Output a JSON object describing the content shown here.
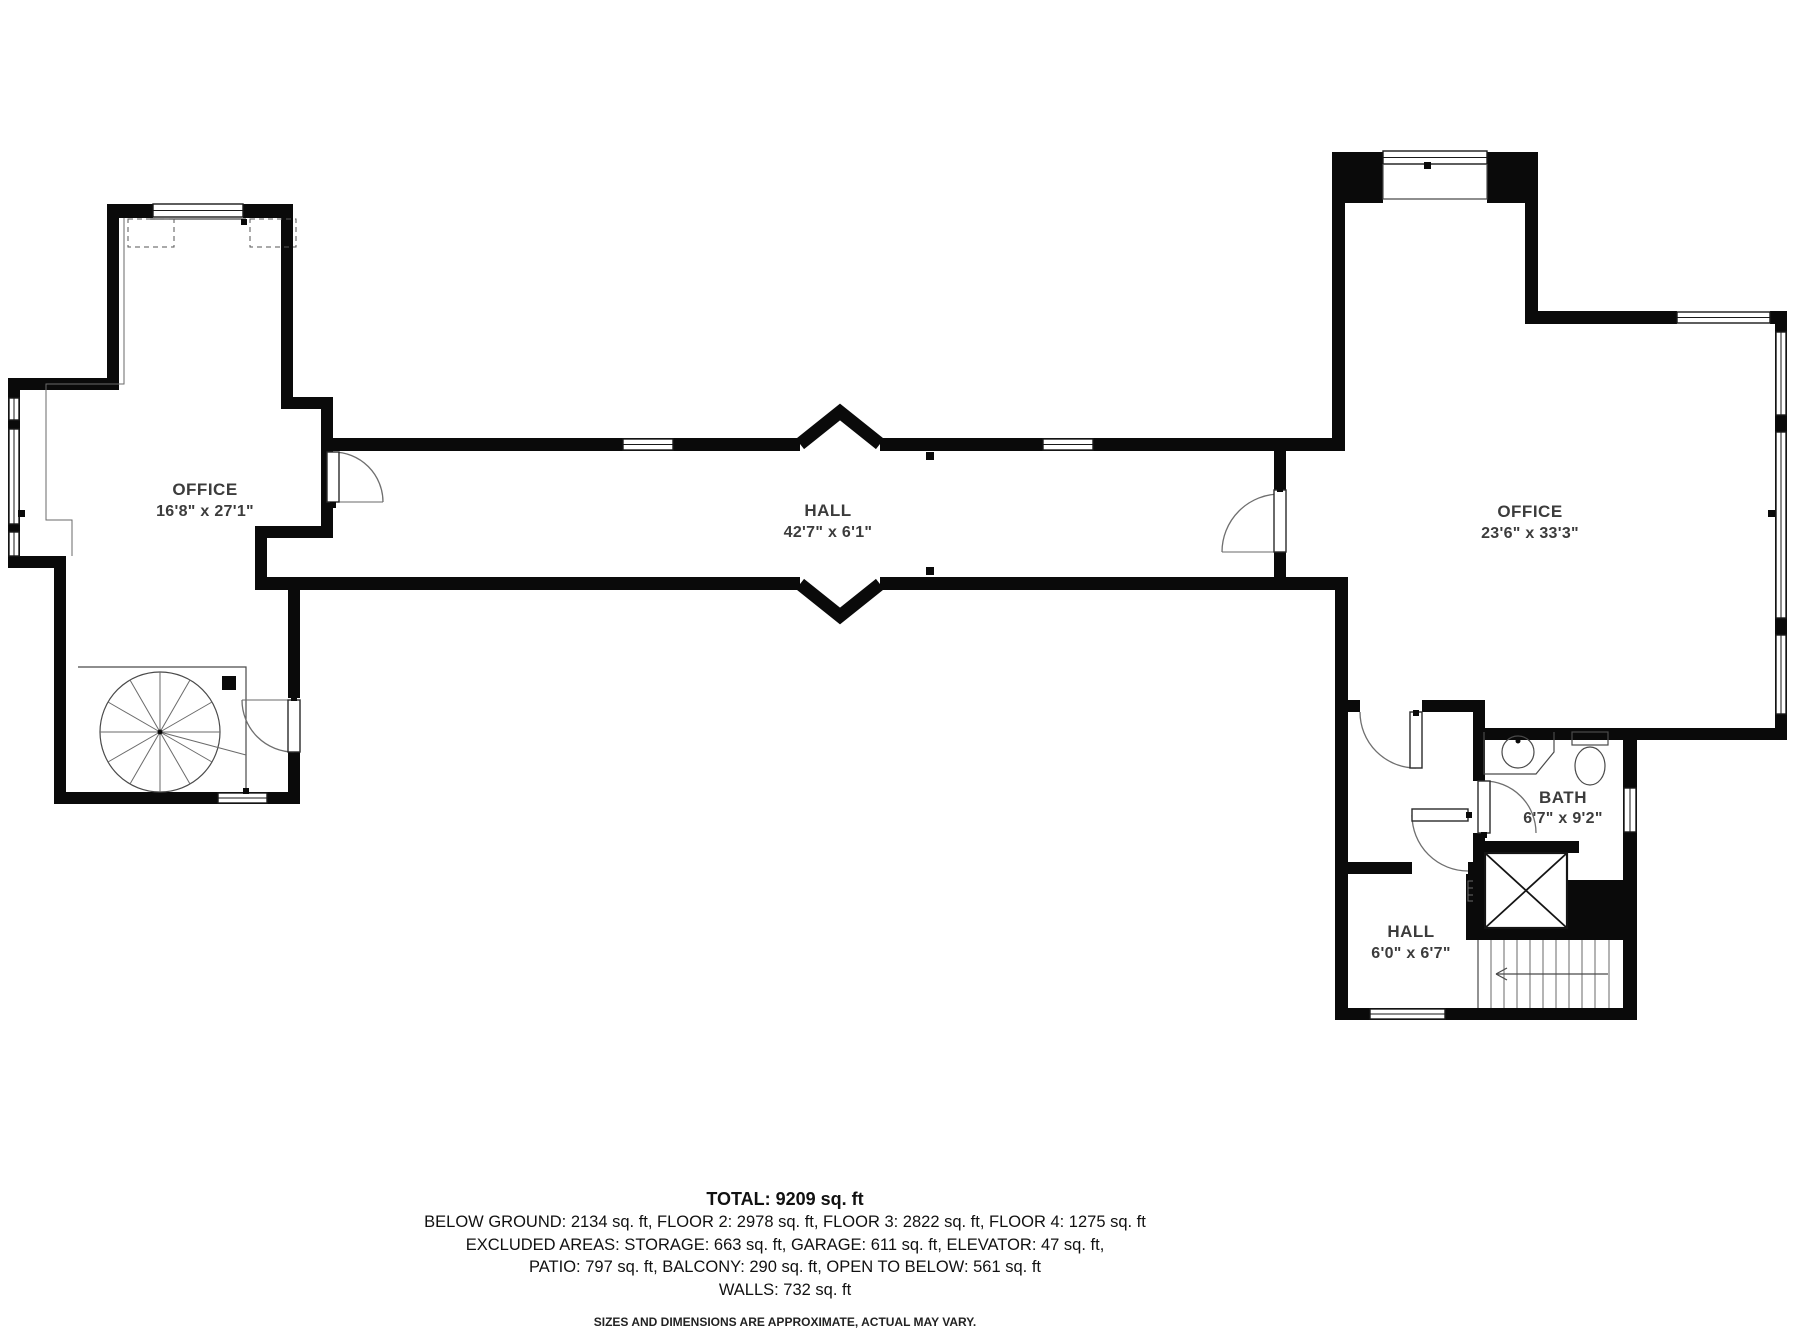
{
  "plan": {
    "rooms": [
      {
        "id": "office-left",
        "label": "OFFICE",
        "dims": "16'8\" x 27'1\""
      },
      {
        "id": "hall-main",
        "label": "HALL",
        "dims": "42'7\" x 6'1\""
      },
      {
        "id": "office-right",
        "label": "OFFICE",
        "dims": "23'6\" x 33'3\""
      },
      {
        "id": "bath",
        "label": "BATH",
        "dims": "6'7\" x 9'2\""
      },
      {
        "id": "hall-small",
        "label": "HALL",
        "dims": "6'0\" x 6'7\""
      }
    ]
  },
  "summary": {
    "total": "TOTAL: 9209 sq. ft",
    "line1": "BELOW GROUND: 2134 sq. ft, FLOOR 2: 2978 sq. ft, FLOOR 3: 2822 sq. ft, FLOOR 4: 1275 sq. ft",
    "line2": "EXCLUDED AREAS: STORAGE: 663 sq. ft, GARAGE: 611 sq. ft, ELEVATOR: 47 sq. ft,",
    "line3": "PATIO: 797 sq. ft, BALCONY: 290 sq. ft, OPEN TO BELOW: 561 sq. ft",
    "line4": "WALLS: 732 sq. ft",
    "disclaimer": "SIZES AND DIMENSIONS ARE APPROXIMATE, ACTUAL MAY VARY."
  },
  "colors": {
    "wall": "#0a0a0a",
    "background": "#ffffff",
    "thin_line": "#4a4a4a",
    "text": "#3c3c3c"
  }
}
